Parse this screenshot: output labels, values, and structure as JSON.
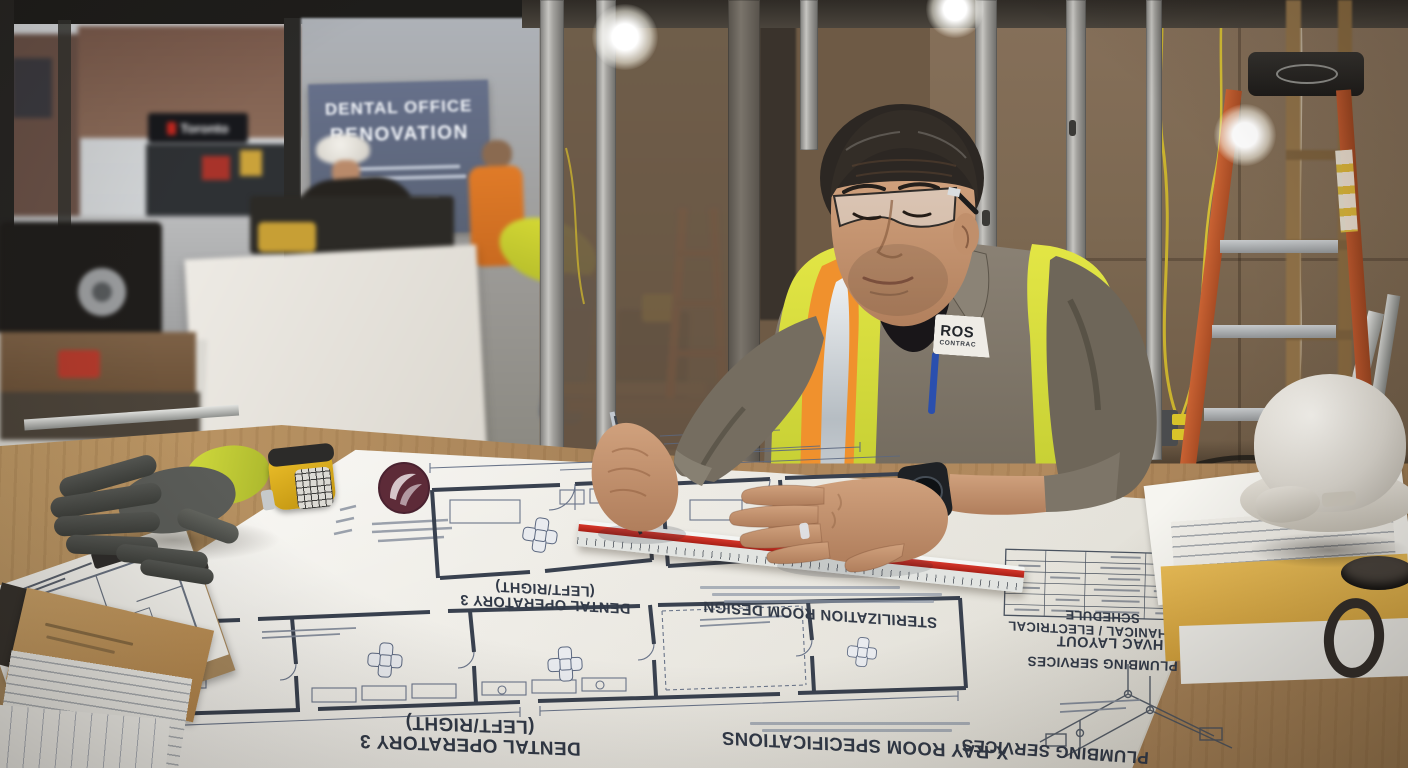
{
  "background": {
    "toronto_sign": "Toronto",
    "site_sign_line1": "DENTAL OFFICE",
    "site_sign_line2": "RENOVATION"
  },
  "worker": {
    "badge_line1": "ROS",
    "badge_line2": "CONTRAC"
  },
  "blueprints": {
    "labels": {
      "operatory_top": "DENTAL OPERATORY 3 (LEFT/RIGHT)",
      "operatory_bottom": "DENTAL OPERATORY 3 (LEFT/RIGHT)",
      "sterilization": "STERILIZATION ROOM DESIGN",
      "xray": "X-RAY ROOM SPECIFICATIONS",
      "mechanical": "MECHANICAL / ELECTRICAL SCHEDULE",
      "hvac": "HVAC LAYOUT",
      "plumbing": "PLUMBING SERVICES",
      "plumbing_bottom": "PLUMBING SERVICES"
    }
  },
  "colors": {
    "vest_yellow": "#d9e23c",
    "vest_orange": "#f0912d",
    "safety_silver": "#c3cad0",
    "ruler_red": "#c83226",
    "blueprint_line": "#5c6880",
    "logo_maroon": "#5d2b38",
    "sign_background": "#5f6a82",
    "hard_hat_white": "#e9e6df",
    "ladder_orange": "#b8552c",
    "wood_table": "#b18a5c",
    "drywall_brown": "#7d6952",
    "mug_black": "#2e2926",
    "tape_measure_yellow": "#dfb02a",
    "glove_green": "#c6cf36"
  }
}
